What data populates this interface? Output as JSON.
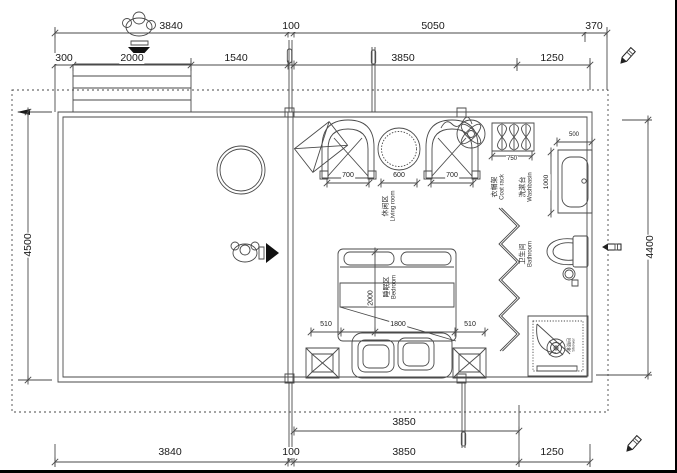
{
  "drawing": {
    "dims": {
      "top_row1": [
        "3840",
        "100",
        "5050",
        "370"
      ],
      "top_row2": [
        "300",
        "2000",
        "1540",
        "3850",
        "1250"
      ],
      "bottom_row1": [
        "3850"
      ],
      "bottom_row2": [
        "3840",
        "100",
        "3850",
        "1250"
      ],
      "left_height": "4500",
      "right_height": "4400",
      "living_furniture": [
        "700",
        "600",
        "700"
      ],
      "coat_rack_width": "750",
      "washbasin_width": "500",
      "washbasin_depth": "1000",
      "bed_width": "1800",
      "bed_length": "2000",
      "nightstand_left": "510",
      "nightstand_right": "510"
    },
    "rooms": {
      "living": {
        "zh": "休闲区",
        "en": "Living room"
      },
      "bedroom": {
        "zh": "睡眠区",
        "en": "Bedroom"
      },
      "bathroom": {
        "zh": "卫生间",
        "en": "Bathroom"
      },
      "washbasin": {
        "zh": "洗漱台",
        "en": "Washbasin"
      },
      "coat_rack": {
        "zh": "衣帽架",
        "en": "Coat rack"
      },
      "shower": {
        "zh": "淋浴间",
        "en": "Shower"
      }
    },
    "colors": {
      "line": "#4a4a4a",
      "dark": "#1a1a1a",
      "boundary": "#999999",
      "background": "#ffffff"
    }
  }
}
